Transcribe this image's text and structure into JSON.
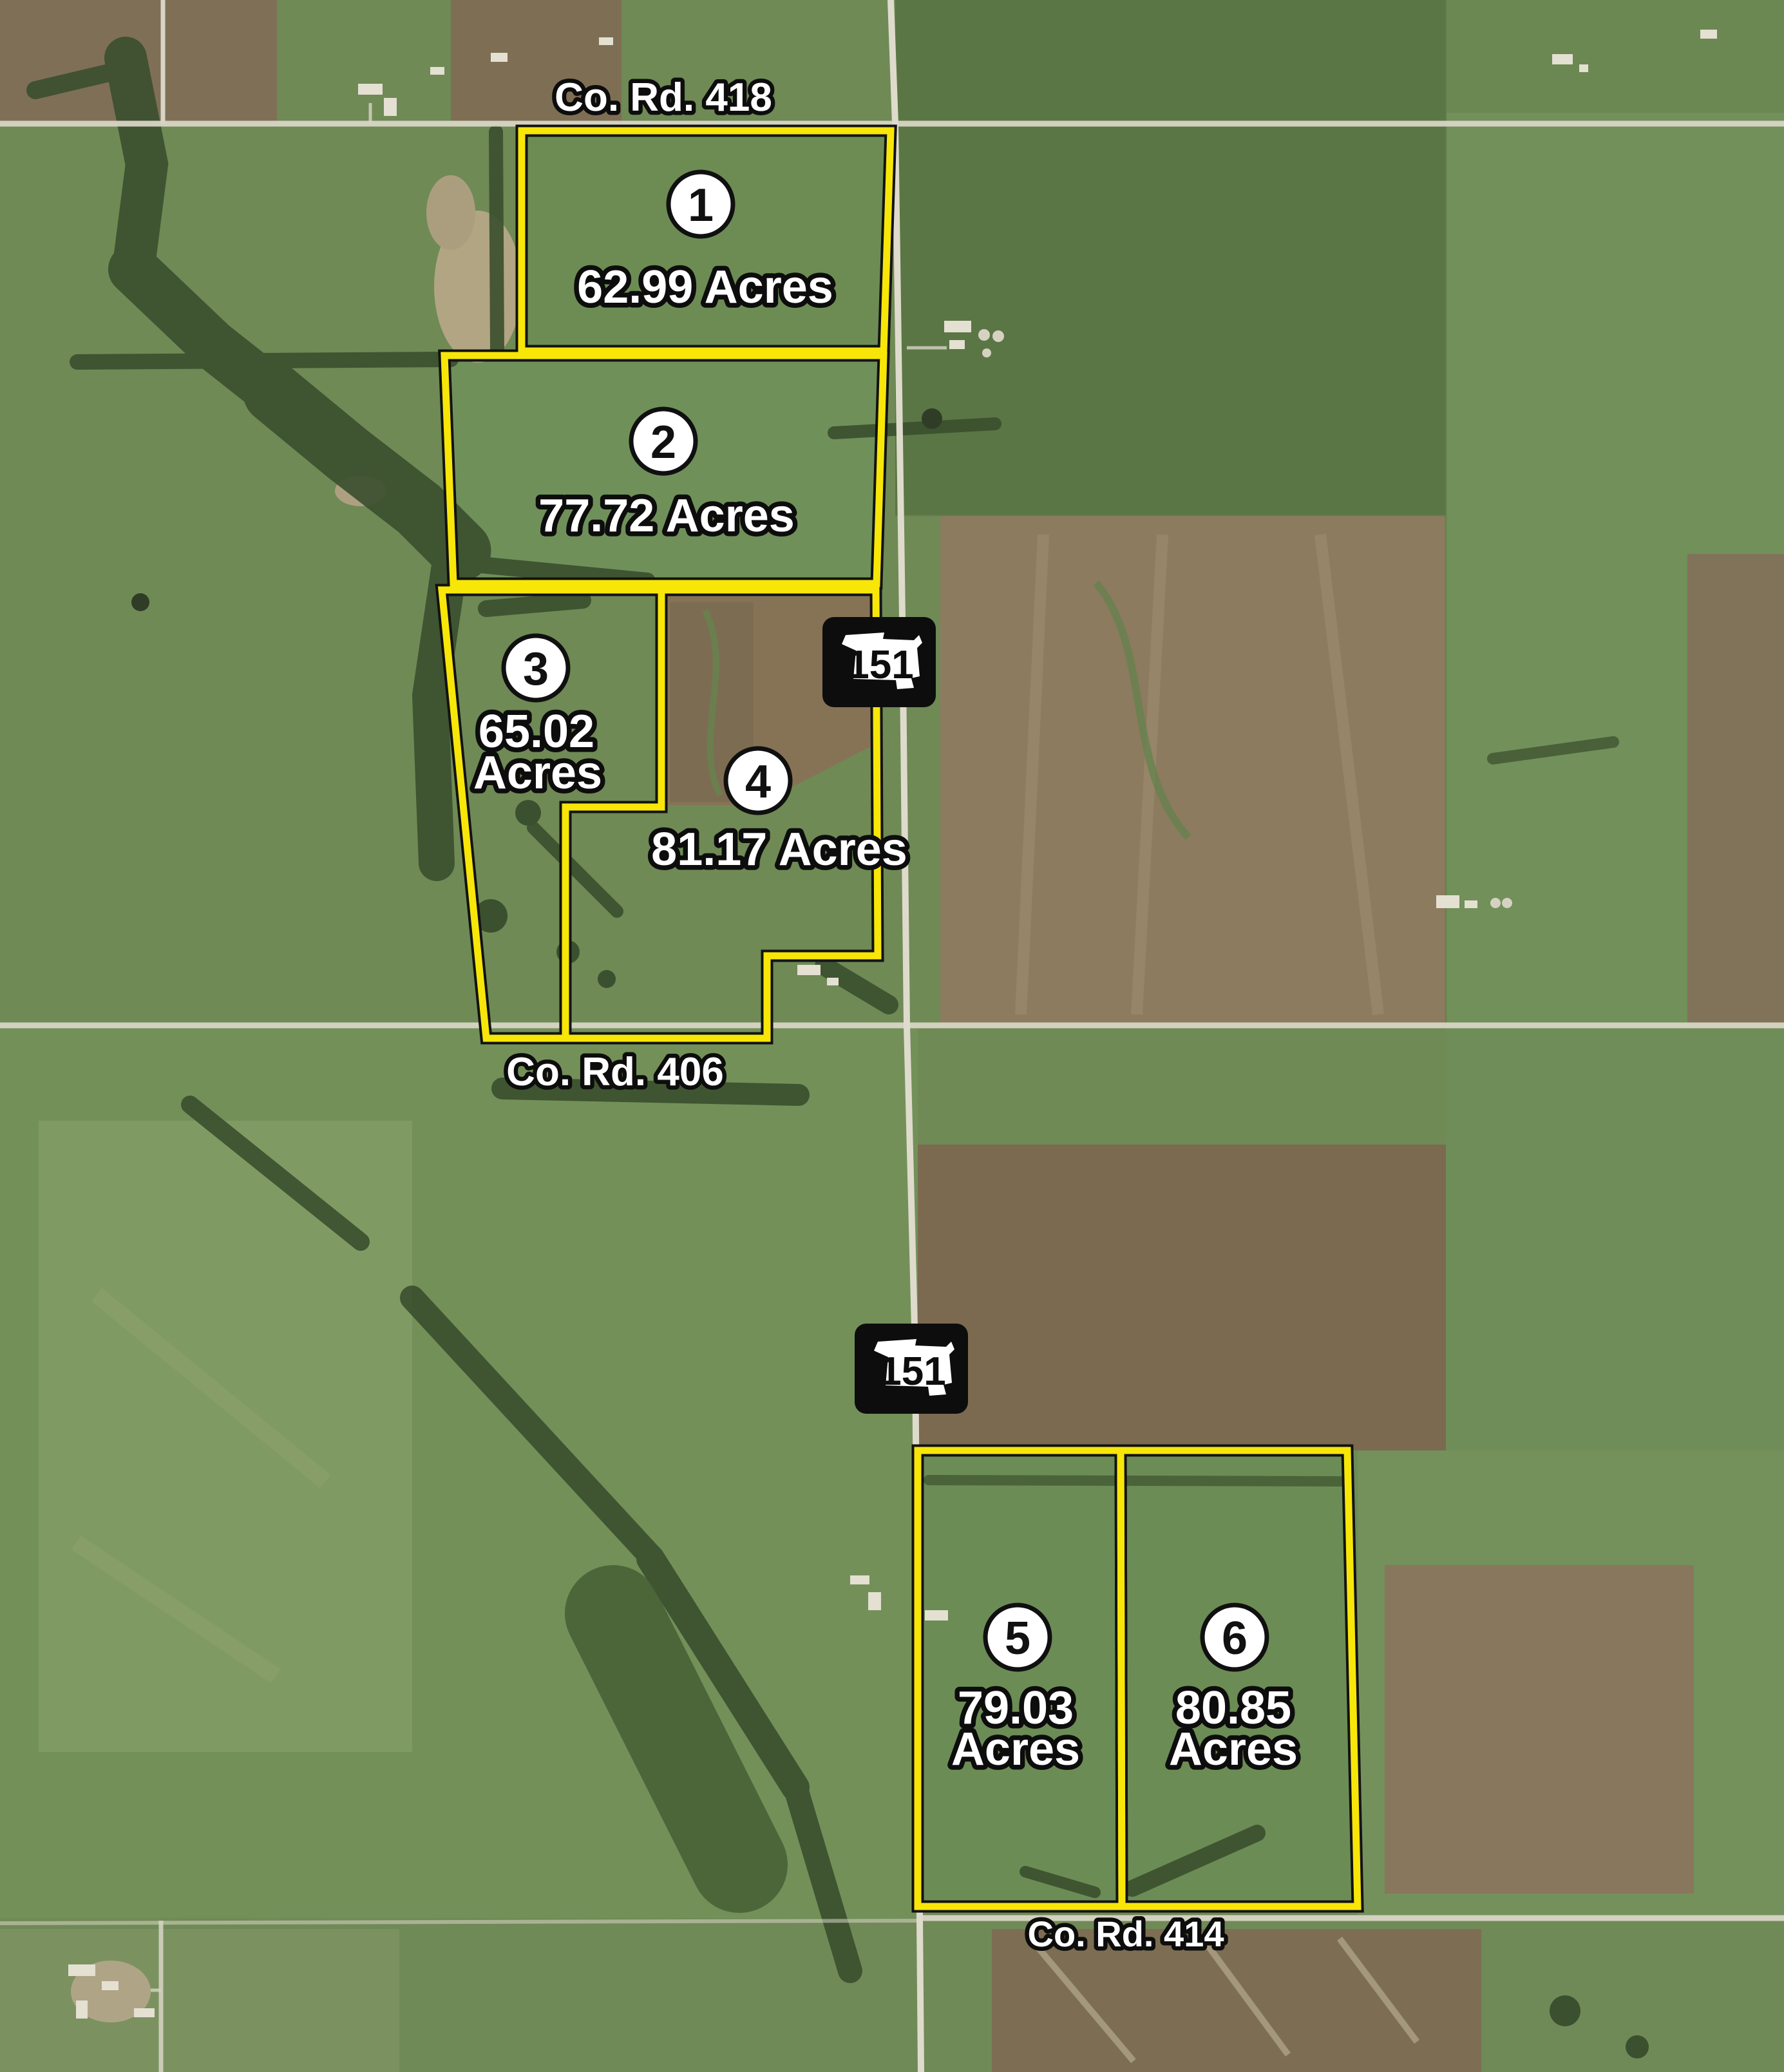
{
  "roads": {
    "north": "Co. Rd. 418",
    "middle": "Co. Rd. 406",
    "south": "Co. Rd. 414"
  },
  "highway": {
    "route": "151"
  },
  "tracts": [
    {
      "number": "1",
      "acres": 62.99,
      "label_line1": "62.99 Acres"
    },
    {
      "number": "2",
      "acres": 77.72,
      "label_line1": "77.72 Acres"
    },
    {
      "number": "3",
      "acres": 65.02,
      "label_line1": "65.02",
      "label_line2": "Acres"
    },
    {
      "number": "4",
      "acres": 81.17,
      "label_line1": "81.17 Acres"
    },
    {
      "number": "5",
      "acres": 79.03,
      "label_line1": "79.03",
      "label_line2": "Acres"
    },
    {
      "number": "6",
      "acres": 80.85,
      "label_line1": "80.85",
      "label_line2": "Acres"
    }
  ],
  "colors": {
    "boundary_yellow": "#f7e608",
    "label_text": "#ffffff",
    "label_outline": "#0d0d0d",
    "shield_background": "#0d0d0d",
    "shield_state": "#ffffff"
  }
}
